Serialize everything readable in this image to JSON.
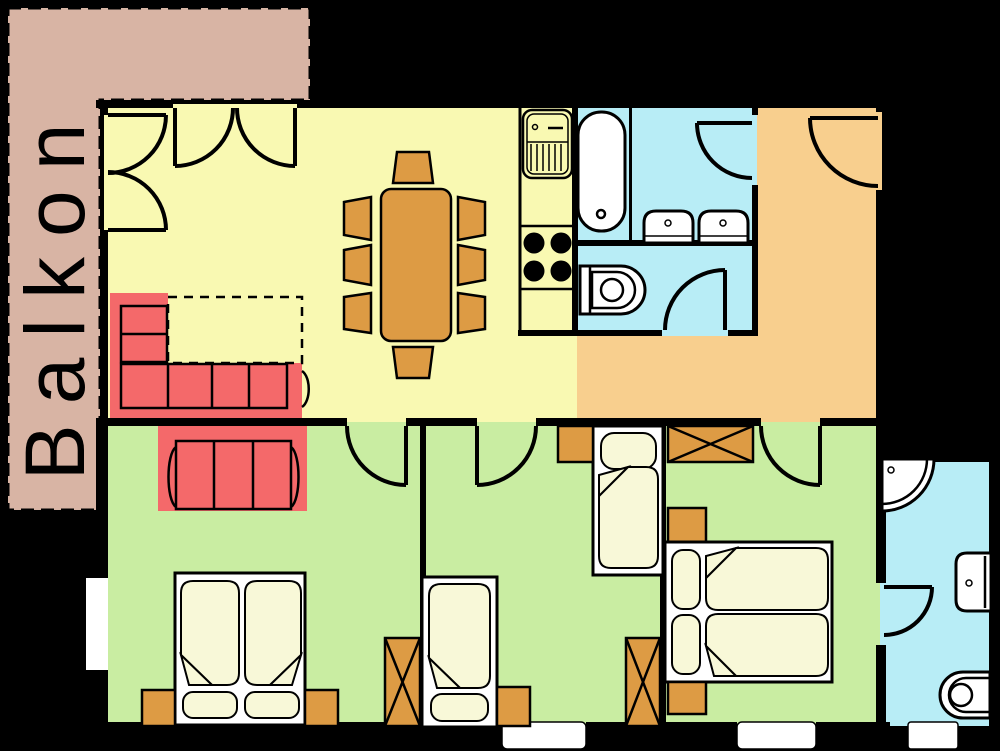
{
  "title": "Apartment floor plan with balcony",
  "labels": {
    "balcony": "Balkon"
  },
  "palette": {
    "background": "#000000",
    "wall": "#000000",
    "balcony": "#d8b4a4",
    "living": "#f9f9b2",
    "hallway": "#f8cf8e",
    "bathroom": "#b8edf6",
    "bedroom": "#c9eda2",
    "wood": "#dd9b44",
    "sofa": "#f4696a",
    "cream": "#f8f8d8",
    "fixture": "#ffffff"
  },
  "rooms": [
    {
      "name": "balcony",
      "label": "Balkon"
    },
    {
      "name": "living-dining-room"
    },
    {
      "name": "kitchen"
    },
    {
      "name": "bathroom"
    },
    {
      "name": "wc"
    },
    {
      "name": "hallway"
    },
    {
      "name": "bedroom-1"
    },
    {
      "name": "bedroom-2"
    },
    {
      "name": "bedroom-3"
    },
    {
      "name": "ensuite-shower-room"
    }
  ],
  "contents": {
    "living_dining": [
      "double balcony doors (top)",
      "double balcony doors (left)",
      "dining table",
      "8 chairs",
      "red corner sofa",
      "dashed layout outline"
    ],
    "kitchen": [
      "counter strip",
      "sink with drainboard",
      "stove with 4 burners"
    ],
    "bathroom": [
      "bathtub",
      "2 washbasins",
      "door to hallway"
    ],
    "wc": [
      "toilet",
      "door"
    ],
    "hallway": [
      "entrance door"
    ],
    "bedroom_1": [
      "red sofa",
      "double bed",
      "2 nightstands",
      "wardrobe",
      "window"
    ],
    "bedroom_2": [
      "2 single beds",
      "2 nightstands",
      "wardrobe"
    ],
    "bedroom_3": [
      "double bed",
      "2 nightstands",
      "wardrobe",
      "door to ensuite"
    ],
    "ensuite": [
      "corner shower",
      "washbasin",
      "toilet",
      "exterior opening"
    ]
  }
}
